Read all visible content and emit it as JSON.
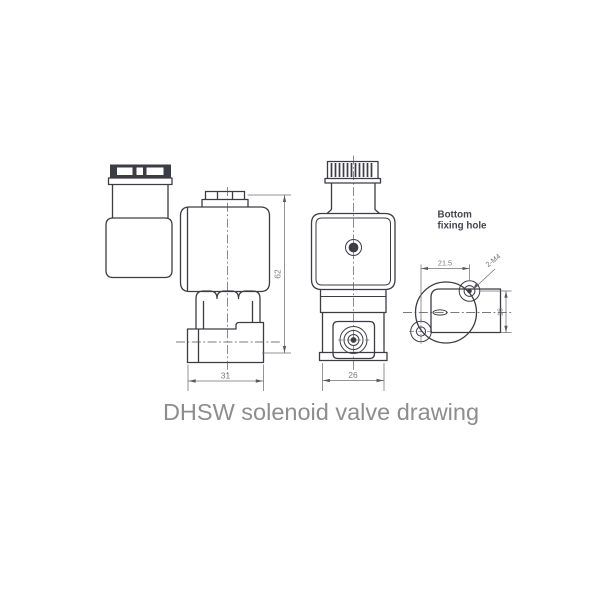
{
  "title": "DHSW solenoid valve drawing",
  "views": {
    "side": {
      "width_dim": "31",
      "height_dim": "62"
    },
    "front": {
      "width_dim": "26"
    },
    "bottom": {
      "label_line1": "Bottom",
      "label_line2": "fixing hole",
      "holes_h_spacing_dim": "21.5",
      "holes_v_spacing_dim": "16",
      "holes_label": "2-M4"
    }
  },
  "colors": {
    "outline": "#3c3c44",
    "dimension": "#70707a",
    "centerline": "#4c4c55",
    "title_text": "#8d8d8d",
    "label_text": "#45454d",
    "background": "#ffffff"
  }
}
